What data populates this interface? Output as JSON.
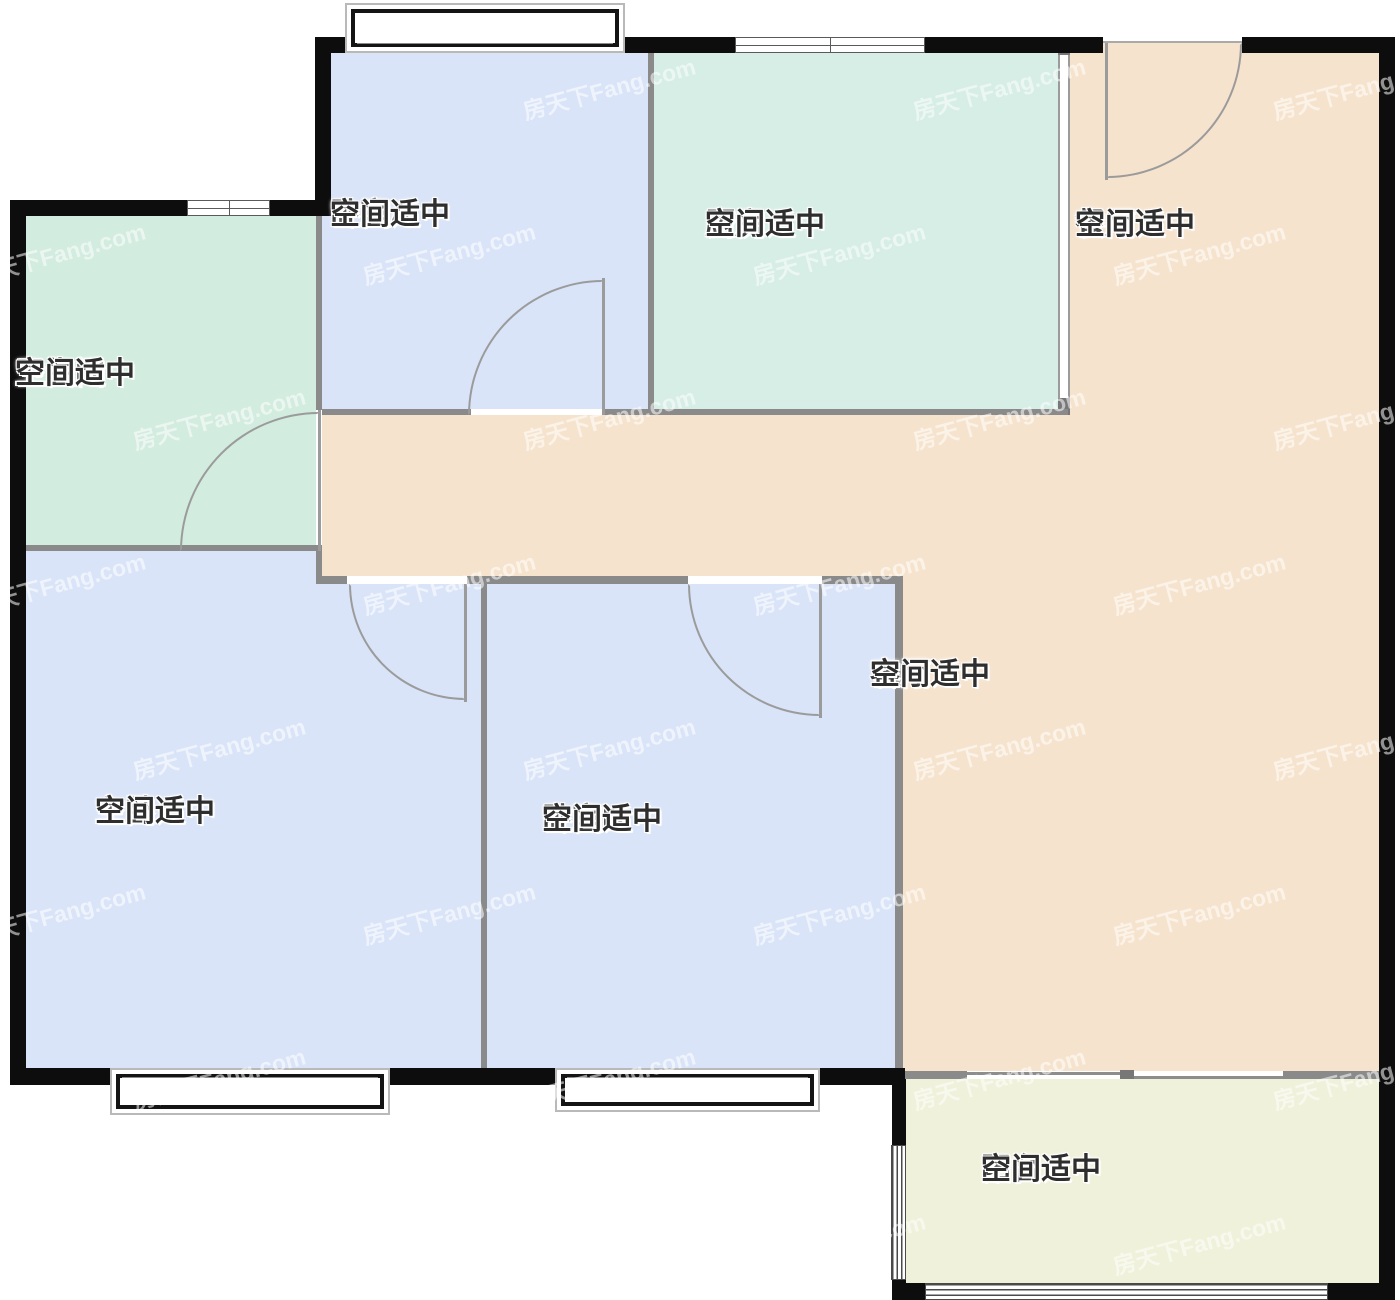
{
  "plan": {
    "watermark": "房天下Fang.com",
    "note_label": "空间适中",
    "rooms": [
      {
        "id": "bedroom-a",
        "name": "卧室A",
        "note": "空间适中"
      },
      {
        "id": "kitchen",
        "name": "厨房",
        "note": "空间适中"
      },
      {
        "id": "dining",
        "name": "餐厅",
        "note": "空间适中"
      },
      {
        "id": "bathroom",
        "name": "卫生间",
        "note": "空间适中"
      },
      {
        "id": "master-bedroom",
        "name": "主卧",
        "note": "空间适中"
      },
      {
        "id": "bedroom-b",
        "name": "卧室B",
        "note": "空间适中"
      },
      {
        "id": "living-room",
        "name": "客厅",
        "note": "空间适中"
      },
      {
        "id": "balcony",
        "name": "阳台",
        "note": "空间适中"
      }
    ],
    "colors": {
      "bedroom": "#d9e4f8",
      "kitchen": "#d6eee5",
      "bathroom": "#d2ecdf",
      "living": "#f6e3cd",
      "balcony": "#f0f1da",
      "exterior_wall": "#0d0d0d",
      "interior_wall": "#8a8a8a",
      "door_line": "#9b9b9b"
    }
  }
}
